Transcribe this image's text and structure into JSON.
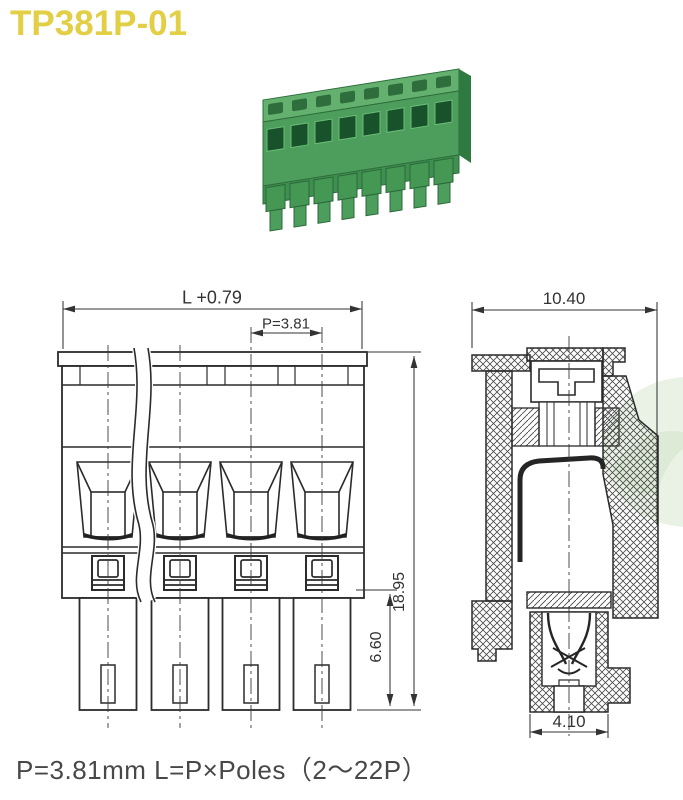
{
  "title": {
    "text": "TP381P-01",
    "color": "#e3cf45"
  },
  "photo": {
    "description": "8-pole green pluggable terminal block, angled product photo",
    "pole_count": 8,
    "body_color": "#4d9e5c",
    "top_color": "#63b06f",
    "hole_color": "#17522a"
  },
  "front_view": {
    "poles_shown": 4,
    "dim_total_width": "L +0.79",
    "dim_pitch": "P=3.81",
    "dim_total_height": "18.95",
    "dim_leg_height": "6.60"
  },
  "side_view": {
    "dim_width": "10.40",
    "dim_pin_width": "4.10"
  },
  "footer": {
    "note": "P=3.81mm  L=P×Poles（2～22P）"
  },
  "colors": {
    "line": "#2b2b2b",
    "dimension": "#333333",
    "watermark": "#e3eede"
  }
}
